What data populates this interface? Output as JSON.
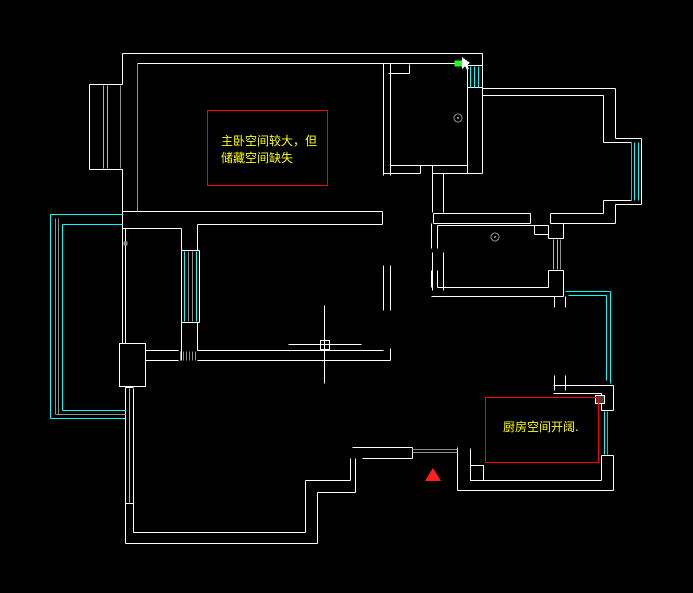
{
  "app": {
    "background": "#000000",
    "canvas_label": "cad-floorplan-canvas"
  },
  "annotations": {
    "master_note": {
      "line1": "主卧空间较大，但",
      "line2": "储藏空间缺失",
      "box": [
        207,
        110,
        120,
        75
      ],
      "border_color": "#ff0000",
      "text_color": "#ffff00"
    },
    "kitchen_note": {
      "line1": "厨房空间开阔.",
      "box": [
        485,
        397,
        113,
        65
      ],
      "border_color": "#ff0000",
      "text_color": "#ffff00"
    }
  },
  "cursor": {
    "crosshair_x": 324,
    "crosshair_y": 344,
    "pickbox": [
      320,
      340,
      9,
      9
    ],
    "h_line": [
      288,
      344,
      361,
      344
    ],
    "v_line": [
      324,
      305,
      324,
      383
    ]
  },
  "drawing": {
    "palette": {
      "w": "#ffffff",
      "g": "#8f8f8f",
      "c": "#00ffff",
      "r": "#ff0000",
      "y": "#ffff00",
      "gn": "#21ff21",
      "dg": "#3f3f3f",
      "tr": "#ff1f1f"
    },
    "segments": [
      [
        122,
        53,
        482,
        53,
        "w"
      ],
      [
        137,
        63,
        467,
        63,
        "w"
      ],
      [
        122,
        53,
        122,
        84,
        "w"
      ],
      [
        122,
        169,
        122,
        214,
        "w"
      ],
      [
        89,
        84,
        89,
        169,
        "w"
      ],
      [
        89,
        84,
        122,
        84,
        "w"
      ],
      [
        89,
        169,
        122,
        169,
        "w"
      ],
      [
        467,
        63,
        467,
        173,
        "w"
      ],
      [
        482,
        53,
        482,
        95,
        "w"
      ],
      [
        467,
        65,
        482,
        65,
        "w"
      ],
      [
        467,
        87,
        482,
        87,
        "w"
      ],
      [
        482,
        88,
        615,
        88,
        "w"
      ],
      [
        482,
        95,
        603,
        95,
        "w"
      ],
      [
        603,
        95,
        603,
        142,
        "w"
      ],
      [
        603,
        200,
        603,
        213,
        "w"
      ],
      [
        615,
        88,
        615,
        138,
        "w"
      ],
      [
        615,
        138,
        641,
        138,
        "w"
      ],
      [
        641,
        138,
        641,
        204,
        "w"
      ],
      [
        615,
        204,
        641,
        204,
        "w"
      ],
      [
        615,
        204,
        615,
        223,
        "w"
      ],
      [
        603,
        142,
        631,
        142,
        "w"
      ],
      [
        603,
        200,
        631,
        200,
        "w"
      ],
      [
        433,
        213,
        530,
        213,
        "w"
      ],
      [
        550,
        213,
        603,
        213,
        "w"
      ],
      [
        433,
        223,
        530,
        223,
        "w"
      ],
      [
        550,
        223,
        615,
        223,
        "w"
      ],
      [
        530,
        213,
        530,
        223,
        "w"
      ],
      [
        550,
        213,
        550,
        223,
        "w"
      ],
      [
        433,
        213,
        433,
        223,
        "w"
      ],
      [
        390,
        165,
        467,
        165,
        "w"
      ],
      [
        383,
        173,
        420,
        173,
        "w"
      ],
      [
        432,
        173,
        470,
        173,
        "w"
      ],
      [
        420,
        165,
        420,
        173,
        "w"
      ],
      [
        432,
        165,
        432,
        173,
        "w"
      ],
      [
        383,
        63,
        383,
        175,
        "w"
      ],
      [
        390,
        63,
        390,
        175,
        "w"
      ],
      [
        482,
        95,
        482,
        173,
        "w"
      ],
      [
        467,
        173,
        482,
        173,
        "w"
      ],
      [
        388,
        73,
        409,
        73,
        "w"
      ],
      [
        409,
        64,
        409,
        73,
        "w"
      ],
      [
        122,
        211,
        382,
        211,
        "w"
      ],
      [
        122,
        228,
        181,
        228,
        "w"
      ],
      [
        197,
        224,
        382,
        224,
        "w"
      ],
      [
        382,
        211,
        382,
        224,
        "w"
      ],
      [
        383,
        265,
        383,
        310,
        "w"
      ],
      [
        390,
        265,
        390,
        310,
        "w"
      ],
      [
        432,
        173,
        432,
        212,
        "w"
      ],
      [
        443,
        173,
        443,
        212,
        "w"
      ],
      [
        432,
        252,
        432,
        290,
        "w"
      ],
      [
        443,
        252,
        443,
        290,
        "w"
      ],
      [
        431,
        223,
        431,
        248,
        "w"
      ],
      [
        437,
        225,
        437,
        248,
        "w"
      ],
      [
        431,
        270,
        431,
        287,
        "w"
      ],
      [
        437,
        270,
        437,
        287,
        "w"
      ],
      [
        437,
        225,
        548,
        225,
        "w"
      ],
      [
        548,
        225,
        548,
        238,
        "w"
      ],
      [
        548,
        270,
        548,
        287,
        "w"
      ],
      [
        563,
        223,
        563,
        238,
        "w"
      ],
      [
        563,
        270,
        563,
        296,
        "w"
      ],
      [
        548,
        238,
        563,
        238,
        "w"
      ],
      [
        548,
        270,
        563,
        270,
        "w"
      ],
      [
        437,
        287,
        548,
        287,
        "w"
      ],
      [
        431,
        296,
        563,
        296,
        "w"
      ],
      [
        534,
        225,
        534,
        234,
        "w"
      ],
      [
        534,
        234,
        548,
        234,
        "w"
      ],
      [
        554,
        296,
        554,
        307,
        "w"
      ],
      [
        565,
        296,
        565,
        307,
        "w"
      ],
      [
        554,
        375,
        554,
        390,
        "w"
      ],
      [
        565,
        375,
        565,
        390,
        "w"
      ],
      [
        553,
        385,
        613,
        385,
        "w"
      ],
      [
        553,
        393,
        601,
        393,
        "w"
      ],
      [
        601,
        393,
        601,
        410,
        "w"
      ],
      [
        601,
        455,
        601,
        480,
        "w"
      ],
      [
        613,
        385,
        613,
        410,
        "w"
      ],
      [
        613,
        455,
        613,
        490,
        "w"
      ],
      [
        601,
        410,
        613,
        410,
        "w"
      ],
      [
        601,
        455,
        613,
        455,
        "w"
      ],
      [
        470,
        480,
        601,
        480,
        "w"
      ],
      [
        457,
        490,
        613,
        490,
        "w"
      ],
      [
        352,
        447,
        412,
        447,
        "w"
      ],
      [
        362,
        458,
        412,
        458,
        "w"
      ],
      [
        412,
        447,
        412,
        458,
        "w"
      ],
      [
        457,
        447,
        457,
        490,
        "w"
      ],
      [
        470,
        448,
        470,
        465,
        "w"
      ],
      [
        350,
        458,
        350,
        480,
        "w"
      ],
      [
        355,
        458,
        355,
        492,
        "w"
      ],
      [
        305,
        480,
        350,
        480,
        "w"
      ],
      [
        317,
        492,
        355,
        492,
        "w"
      ],
      [
        305,
        480,
        305,
        532,
        "w"
      ],
      [
        317,
        492,
        317,
        543,
        "w"
      ],
      [
        133,
        532,
        305,
        532,
        "w"
      ],
      [
        125,
        543,
        317,
        543,
        "w"
      ],
      [
        125,
        387,
        125,
        503,
        "w"
      ],
      [
        133,
        388,
        133,
        503,
        "w"
      ],
      [
        125,
        387,
        133,
        387,
        "w"
      ],
      [
        125,
        503,
        133,
        503,
        "w"
      ],
      [
        125,
        503,
        125,
        543,
        "w"
      ],
      [
        133,
        503,
        133,
        532,
        "w"
      ],
      [
        122,
        214,
        122,
        343,
        "w"
      ],
      [
        125,
        228,
        125,
        343,
        "w"
      ],
      [
        145,
        350,
        178,
        350,
        "w"
      ],
      [
        197,
        350,
        383,
        350,
        "w"
      ],
      [
        145,
        360,
        178,
        360,
        "w"
      ],
      [
        197,
        360,
        390,
        360,
        "w"
      ],
      [
        390,
        348,
        390,
        360,
        "w"
      ],
      [
        181,
        250,
        181,
        322,
        "w"
      ],
      [
        199,
        250,
        199,
        322,
        "w"
      ],
      [
        181,
        250,
        199,
        250,
        "w"
      ],
      [
        181,
        322,
        199,
        322,
        "w"
      ],
      [
        197,
        224,
        197,
        250,
        "w"
      ],
      [
        181,
        228,
        181,
        250,
        "w"
      ],
      [
        197,
        322,
        197,
        350,
        "w"
      ],
      [
        181,
        322,
        181,
        360,
        "w"
      ],
      [
        137,
        63,
        137,
        211,
        "g"
      ],
      [
        120,
        85,
        120,
        168,
        "g"
      ],
      [
        55,
        218,
        55,
        414,
        "g"
      ],
      [
        58,
        218,
        58,
        414,
        "g"
      ],
      [
        55,
        414,
        125,
        414,
        "g"
      ],
      [
        188,
        251,
        188,
        321,
        "g"
      ],
      [
        192,
        251,
        192,
        321,
        "g"
      ],
      [
        412,
        449,
        457,
        449,
        "g"
      ],
      [
        412,
        452,
        457,
        452,
        "g"
      ],
      [
        180,
        351,
        180,
        360,
        "g"
      ],
      [
        183,
        351,
        183,
        360,
        "g"
      ],
      [
        186,
        351,
        186,
        360,
        "g"
      ],
      [
        189,
        351,
        189,
        360,
        "g"
      ],
      [
        192,
        351,
        192,
        360,
        "g"
      ],
      [
        195,
        351,
        195,
        360,
        "g"
      ],
      [
        631,
        142,
        631,
        200,
        "g"
      ],
      [
        560,
        239,
        560,
        269,
        "g"
      ],
      [
        607,
        411,
        607,
        454,
        "g"
      ],
      [
        103,
        85,
        103,
        168,
        "c"
      ],
      [
        107,
        85,
        107,
        168,
        "c"
      ],
      [
        470,
        66,
        470,
        87,
        "c"
      ],
      [
        474,
        66,
        474,
        87,
        "c"
      ],
      [
        478,
        66,
        478,
        87,
        "c"
      ],
      [
        634,
        142,
        634,
        200,
        "c"
      ],
      [
        638,
        142,
        638,
        200,
        "c"
      ],
      [
        553,
        239,
        553,
        269,
        "c"
      ],
      [
        557,
        239,
        557,
        269,
        "c"
      ],
      [
        184,
        251,
        184,
        321,
        "c"
      ],
      [
        196,
        251,
        196,
        321,
        "c"
      ],
      [
        129,
        388,
        129,
        502,
        "c"
      ],
      [
        50,
        214,
        50,
        418,
        "c"
      ],
      [
        50,
        214,
        122,
        214,
        "c"
      ],
      [
        50,
        418,
        125,
        418,
        "c"
      ],
      [
        62,
        224,
        62,
        410,
        "c"
      ],
      [
        62,
        224,
        122,
        224,
        "c"
      ],
      [
        62,
        410,
        125,
        410,
        "c"
      ],
      [
        565,
        291,
        610,
        291,
        "c"
      ],
      [
        610,
        291,
        610,
        383,
        "c"
      ],
      [
        568,
        295,
        606,
        295,
        "c"
      ],
      [
        606,
        295,
        606,
        380,
        "c"
      ],
      [
        604,
        411,
        604,
        454,
        "c"
      ]
    ],
    "rects": [
      {
        "r": [
          119,
          343,
          26,
          43
        ],
        "stroke": "w",
        "fill": null,
        "name": "wall-pillar"
      },
      {
        "r": [
          470,
          465,
          13,
          15
        ],
        "stroke": "w",
        "fill": null,
        "name": "door-jamb"
      },
      {
        "r": [
          595,
          395,
          9,
          8
        ],
        "stroke": "w",
        "fill": "dg",
        "name": "column"
      },
      {
        "r": [
          454,
          60,
          8,
          6
        ],
        "stroke": null,
        "fill": "gn",
        "name": "selection-grip"
      },
      {
        "r": [
          123,
          241,
          4,
          4
        ],
        "stroke": null,
        "fill": "g",
        "name": "wall-dot"
      }
    ],
    "circles": [
      {
        "c": [
          458,
          118,
          4
        ],
        "stroke": "g",
        "name": "drain-symbol"
      },
      {
        "c": [
          495,
          237,
          4
        ],
        "stroke": "g",
        "name": "drain-symbol"
      }
    ],
    "polys": [
      {
        "pts": [
          [
            433,
            468
          ],
          [
            425,
            481
          ],
          [
            441,
            481
          ]
        ],
        "fill": "tr",
        "name": "entry-marker-triangle"
      },
      {
        "pts": [
          [
            462,
            57
          ],
          [
            462,
            69
          ],
          [
            465,
            66
          ],
          [
            467,
            70
          ],
          [
            469,
            69
          ],
          [
            467,
            65
          ],
          [
            470,
            63
          ]
        ],
        "fill": "w",
        "name": "cursor-arrow"
      }
    ]
  }
}
